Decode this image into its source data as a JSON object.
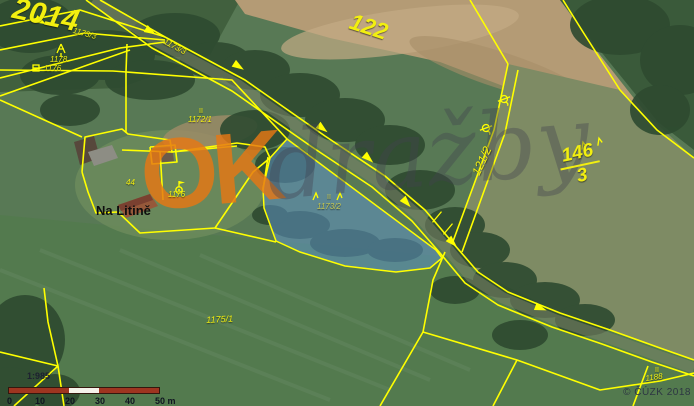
{
  "title": "Cadastral map over aerial photo",
  "colors": {
    "parcel_line": "#ffff00",
    "label_yellow": "#f2ef10",
    "place_label": "#0e0e0e",
    "highlight_fill": "rgba(96,150,210,0.5)",
    "highlight_stroke": "#ffff00",
    "scalebar_red": "#9e3520",
    "scalebar_white": "#f5f2ea",
    "watermark_orange": "rgba(230,120,20,0.82)",
    "watermark_gray": "rgba(66,66,78,0.38)"
  },
  "watermark": {
    "part1": "OK",
    "part2": "dražby"
  },
  "copyright": "© ČÚZK 2018",
  "scalebar": {
    "ratio": "1:985",
    "seg_w": 30,
    "segments": [
      "red",
      "red",
      "white",
      "red",
      "red"
    ],
    "ticks": [
      "0",
      "10",
      "20",
      "30",
      "40",
      "50 m"
    ]
  },
  "map": {
    "labels": [
      {
        "name": "parcel-label-2014",
        "text": "2014",
        "x": 16,
        "y": -6,
        "rot": 12,
        "size": 30,
        "bold": true
      },
      {
        "name": "parcel-label-122",
        "text": "122",
        "x": 354,
        "y": 10,
        "rot": 18,
        "size": 23,
        "bold": true
      },
      {
        "name": "parcel-label-1173-3-a",
        "text": "1173/3",
        "x": 74,
        "y": 27,
        "rot": 15,
        "size": 8
      },
      {
        "name": "parcel-label-1173-3-b",
        "text": "1173/3",
        "x": 166,
        "y": 38,
        "rot": 28,
        "size": 8
      },
      {
        "name": "parcel-label-1178",
        "text": "1178",
        "x": 50,
        "y": 56,
        "rot": 0,
        "size": 8
      },
      {
        "name": "parcel-label-1176-a",
        "text": "1176",
        "x": 44,
        "y": 65,
        "rot": 0,
        "size": 8
      },
      {
        "name": "parcel-label-1172-1",
        "text": "1172/1",
        "x": 188,
        "y": 116,
        "rot": 0,
        "size": 8
      },
      {
        "name": "land-class-label-1172",
        "text": "II",
        "x": 199,
        "y": 108,
        "rot": 0,
        "size": 7,
        "italic": false
      },
      {
        "name": "building-label-44",
        "text": "44",
        "x": 126,
        "y": 179,
        "rot": 0,
        "size": 8
      },
      {
        "name": "parcel-label-1176-b",
        "text": "1176",
        "x": 168,
        "y": 191,
        "rot": 0,
        "size": 8
      },
      {
        "name": "place-label-na-litine",
        "text": "Na Litině",
        "x": 96,
        "y": 204,
        "rot": 0,
        "size": 13,
        "color": "#0e0e0e",
        "italic": false,
        "bold": true,
        "shadow": false
      },
      {
        "name": "parcel-label-1173-2",
        "text": "1173/2",
        "x": 317,
        "y": 203,
        "rot": 0,
        "size": 8,
        "color": "rgba(205,205,80,0.95)"
      },
      {
        "name": "land-class-label-1173-2",
        "text": "II",
        "x": 327,
        "y": 194,
        "rot": 0,
        "size": 7,
        "italic": false,
        "color": "rgba(205,205,80,0.95)"
      },
      {
        "name": "parcel-label-121-2",
        "text": "121/2",
        "x": 470,
        "y": 172,
        "rot": -65,
        "size": 12
      },
      {
        "name": "parcel-label-1175-1",
        "text": "1175/1",
        "x": 206,
        "y": 316,
        "rot": -3,
        "size": 9
      },
      {
        "name": "parcel-label-1188",
        "text": "1188",
        "x": 645,
        "y": 375,
        "rot": -8,
        "size": 8
      },
      {
        "name": "land-class-label-1188",
        "text": "II",
        "x": 655,
        "y": 367,
        "rot": 0,
        "size": 7,
        "italic": false
      }
    ],
    "fraction_label": {
      "name": "parcel-label-146-3",
      "top": "146",
      "bottom": "3",
      "x": 556,
      "y": 148,
      "rot": -12,
      "size": 19
    },
    "highlight_parcel": {
      "points": [
        [
          287,
          139
        ],
        [
          436,
          250
        ],
        [
          442,
          258
        ],
        [
          430,
          268
        ],
        [
          396,
          272
        ],
        [
          345,
          266
        ],
        [
          300,
          252
        ],
        [
          276,
          241
        ],
        [
          264,
          208
        ],
        [
          263,
          188
        ],
        [
          270,
          158
        ]
      ]
    },
    "lines": [
      {
        "points": [
          [
            100,
            0
          ],
          [
            165,
            37
          ],
          [
            245,
            80
          ],
          [
            325,
            136
          ],
          [
            385,
            176
          ],
          [
            425,
            210
          ],
          [
            452,
            242
          ],
          [
            478,
            272
          ],
          [
            508,
            292
          ],
          [
            560,
            313
          ],
          [
            610,
            330
          ],
          [
            660,
            348
          ],
          [
            694,
            360
          ]
        ]
      },
      {
        "points": [
          [
            86,
            0
          ],
          [
            152,
            48
          ],
          [
            232,
            91
          ],
          [
            312,
            147
          ],
          [
            372,
            187
          ],
          [
            412,
            221
          ],
          [
            440,
            253
          ],
          [
            465,
            283
          ],
          [
            498,
            305
          ],
          [
            552,
            327
          ],
          [
            602,
            344
          ],
          [
            652,
            362
          ],
          [
            694,
            376
          ]
        ]
      },
      {
        "points": [
          [
            0,
            26
          ],
          [
            80,
            10
          ],
          [
            165,
            37
          ]
        ]
      },
      {
        "points": [
          [
            0,
            50
          ],
          [
            85,
            33
          ],
          [
            165,
            40
          ]
        ]
      },
      {
        "points": [
          [
            0,
            78
          ],
          [
            120,
            48
          ],
          [
            165,
            42
          ]
        ]
      },
      {
        "points": [
          [
            0,
            96
          ],
          [
            130,
            50
          ]
        ]
      },
      {
        "points": [
          [
            0,
            70
          ],
          [
            113,
            71
          ],
          [
            232,
            80
          ],
          [
            287,
            139
          ]
        ]
      },
      {
        "points": [
          [
            127,
            44
          ],
          [
            126,
            72
          ],
          [
            126,
            133
          ]
        ]
      },
      {
        "points": [
          [
            82,
            172
          ],
          [
            85,
            137
          ],
          [
            122,
            129
          ],
          [
            128,
            134
          ],
          [
            170,
            140
          ],
          [
            172,
            152
          ],
          [
            237,
            143
          ],
          [
            265,
            147
          ],
          [
            270,
            158
          ],
          [
            253,
            172
          ],
          [
            215,
            228
          ],
          [
            140,
            233
          ],
          [
            118,
            212
          ],
          [
            96,
            213
          ],
          [
            88,
            192
          ],
          [
            82,
            172
          ]
        ]
      },
      {
        "points": [
          [
            122,
            150
          ],
          [
            172,
            152
          ],
          [
            237,
            146
          ]
        ]
      },
      {
        "points": [
          [
            160,
            151
          ],
          [
            163,
            200
          ]
        ]
      },
      {
        "points": [
          [
            150,
            147
          ],
          [
            175,
            145
          ],
          [
            177,
            162
          ],
          [
            152,
            164
          ],
          [
            150,
            147
          ]
        ]
      },
      {
        "points": [
          [
            268,
            157
          ],
          [
            263,
            190
          ]
        ]
      },
      {
        "points": [
          [
            215,
            228
          ],
          [
            276,
            242
          ]
        ]
      },
      {
        "points": [
          [
            470,
            0
          ],
          [
            508,
            64
          ]
        ]
      },
      {
        "points": [
          [
            563,
            0
          ],
          [
            583,
            32
          ],
          [
            620,
            90
          ],
          [
            657,
            130
          ],
          [
            694,
            158
          ]
        ]
      },
      {
        "points": [
          [
            508,
            64
          ],
          [
            494,
            130
          ],
          [
            452,
            244
          ]
        ]
      },
      {
        "points": [
          [
            518,
            70
          ],
          [
            505,
            133
          ],
          [
            462,
            252
          ]
        ]
      },
      {
        "points": [
          [
            445,
            252
          ],
          [
            433,
            280
          ],
          [
            423,
            332
          ]
        ]
      },
      {
        "points": [
          [
            423,
            332
          ],
          [
            517,
            360
          ],
          [
            600,
            390
          ],
          [
            660,
            381
          ],
          [
            694,
            373
          ]
        ]
      },
      {
        "points": [
          [
            517,
            360
          ],
          [
            493,
            406
          ]
        ]
      },
      {
        "points": [
          [
            423,
            332
          ],
          [
            380,
            406
          ]
        ]
      },
      {
        "points": [
          [
            0,
            352
          ],
          [
            58,
            366
          ]
        ]
      },
      {
        "points": [
          [
            58,
            366
          ],
          [
            14,
            406
          ]
        ]
      },
      {
        "points": [
          [
            58,
            366
          ],
          [
            64,
            406
          ]
        ]
      },
      {
        "points": [
          [
            58,
            366
          ],
          [
            48,
            322
          ],
          [
            44,
            288
          ]
        ]
      },
      {
        "points": [
          [
            0,
            100
          ],
          [
            82,
            137
          ]
        ]
      },
      {
        "points": [
          [
            648,
            366
          ],
          [
            633,
            406
          ]
        ]
      }
    ],
    "road_arrows": [
      {
        "x": 40,
        "y": 21,
        "rot": 28
      },
      {
        "x": 150,
        "y": 31,
        "rot": 30
      },
      {
        "x": 238,
        "y": 66,
        "rot": 33
      },
      {
        "x": 322,
        "y": 128,
        "rot": 38
      },
      {
        "x": 368,
        "y": 158,
        "rot": 42
      },
      {
        "x": 406,
        "y": 202,
        "rot": 48
      },
      {
        "x": 452,
        "y": 242,
        "rot": 45
      },
      {
        "x": 540,
        "y": 308,
        "rot": 20
      }
    ],
    "symbols": [
      {
        "type": "tree",
        "name": "tree-icon",
        "x": 61,
        "y": 50,
        "rot": 0
      },
      {
        "type": "boxmark",
        "name": "boundary-mark-icon",
        "x": 36,
        "y": 68,
        "rot": 0
      },
      {
        "type": "flagpoint",
        "name": "survey-point-icon",
        "x": 179,
        "y": 190,
        "rot": 0
      },
      {
        "type": "slucka",
        "name": "parcel-link-icon-a",
        "x": 504,
        "y": 99,
        "rot": -20
      },
      {
        "type": "slucka",
        "name": "parcel-link-icon-b",
        "x": 486,
        "y": 128,
        "rot": -20
      },
      {
        "type": "grass",
        "name": "grass-icon-a",
        "x": 584,
        "y": 146,
        "rot": -15
      },
      {
        "type": "grass",
        "name": "grass-icon-b",
        "x": 600,
        "y": 142,
        "rot": -15
      },
      {
        "type": "grass",
        "name": "grass-icon-c",
        "x": 316,
        "y": 197,
        "rot": 0
      },
      {
        "type": "grass",
        "name": "grass-icon-d",
        "x": 340,
        "y": 197,
        "rot": 0
      },
      {
        "type": "tick",
        "name": "culvert-mark-icon-a",
        "x": 437,
        "y": 217,
        "rot": -50
      },
      {
        "type": "tick",
        "name": "culvert-mark-icon-b",
        "x": 448,
        "y": 229,
        "rot": -50
      }
    ]
  }
}
